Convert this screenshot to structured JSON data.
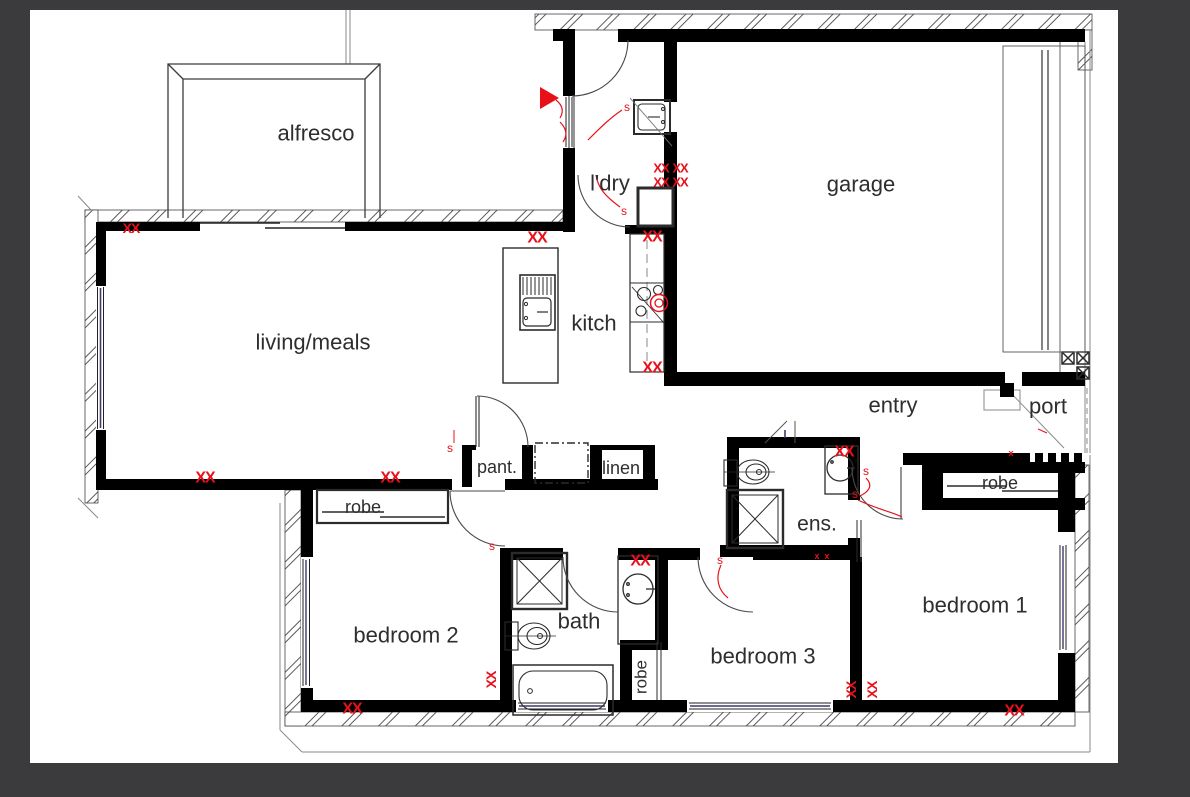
{
  "colors": {
    "background": "#3b3b3d",
    "paper": "#ffffff",
    "wall": "#000000",
    "line": "#3c3c3c",
    "faint": "#999999",
    "window_blue": "#3c3c6e",
    "marker_red": "#e8111a",
    "label": "#2e2e2e"
  },
  "rooms": [
    {
      "id": "alfresco",
      "label": "alfresco",
      "x": 316,
      "y": 133,
      "size": 22,
      "rot": 0
    },
    {
      "id": "living-meals",
      "label": "living/meals",
      "x": 313,
      "y": 342,
      "size": 22,
      "rot": 0
    },
    {
      "id": "kitchen",
      "label": "kitch",
      "x": 594,
      "y": 323,
      "size": 22,
      "rot": 0
    },
    {
      "id": "laundry",
      "label": "l'dry",
      "x": 610,
      "y": 183,
      "size": 22,
      "rot": 0
    },
    {
      "id": "garage",
      "label": "garage",
      "x": 861,
      "y": 184,
      "size": 22,
      "rot": 0
    },
    {
      "id": "entry",
      "label": "entry",
      "x": 893,
      "y": 405,
      "size": 22,
      "rot": 0
    },
    {
      "id": "port",
      "label": "port",
      "x": 1048,
      "y": 406,
      "size": 22,
      "rot": 0
    },
    {
      "id": "pantry",
      "label": "pant.",
      "x": 497,
      "y": 467,
      "size": 18,
      "rot": 0
    },
    {
      "id": "linen",
      "label": "linen",
      "x": 621,
      "y": 468,
      "size": 18,
      "rot": 0
    },
    {
      "id": "robe-bedroom2",
      "label": "robe",
      "x": 363,
      "y": 507,
      "size": 18,
      "rot": 0
    },
    {
      "id": "ensuite",
      "label": "ens.",
      "x": 817,
      "y": 524,
      "size": 21,
      "rot": 0
    },
    {
      "id": "bath",
      "label": "bath",
      "x": 579,
      "y": 621,
      "size": 22,
      "rot": 0
    },
    {
      "id": "bedroom2",
      "label": "bedroom 2",
      "x": 406,
      "y": 635,
      "size": 22,
      "rot": 0
    },
    {
      "id": "robe-bath",
      "label": "robe",
      "x": 641,
      "y": 677,
      "size": 17,
      "rot": -90
    },
    {
      "id": "bedroom3",
      "label": "bedroom 3",
      "x": 763,
      "y": 656,
      "size": 22,
      "rot": 0
    },
    {
      "id": "bedroom1",
      "label": "bedroom 1",
      "x": 975,
      "y": 605,
      "size": 22,
      "rot": 0
    },
    {
      "id": "robe-bedroom1",
      "label": "robe",
      "x": 1000,
      "y": 483,
      "size": 18,
      "rot": 0
    }
  ],
  "markers": {
    "xx_text": "XX",
    "s_text": "s",
    "small_x_text": "x",
    "xx": [
      {
        "x": 131,
        "y": 228,
        "size": 14,
        "rot": 0
      },
      {
        "x": 537,
        "y": 238,
        "size": 16,
        "rot": 0
      },
      {
        "x": 652,
        "y": 237,
        "size": 16,
        "rot": 0
      },
      {
        "x": 661,
        "y": 168,
        "size": 13,
        "rot": 0
      },
      {
        "x": 680,
        "y": 168,
        "size": 13,
        "rot": 0
      },
      {
        "x": 661,
        "y": 182,
        "size": 13,
        "rot": 0
      },
      {
        "x": 680,
        "y": 182,
        "size": 13,
        "rot": 0
      },
      {
        "x": 652,
        "y": 368,
        "size": 16,
        "rot": 0
      },
      {
        "x": 205,
        "y": 478,
        "size": 16,
        "rot": 0
      },
      {
        "x": 390,
        "y": 478,
        "size": 16,
        "rot": 0
      },
      {
        "x": 844,
        "y": 452,
        "size": 16,
        "rot": 0
      },
      {
        "x": 640,
        "y": 561,
        "size": 16,
        "rot": 0
      },
      {
        "x": 352,
        "y": 709,
        "size": 16,
        "rot": 0
      },
      {
        "x": 1014,
        "y": 711,
        "size": 16,
        "rot": 0
      },
      {
        "x": 491,
        "y": 680,
        "size": 14,
        "rot": -90
      },
      {
        "x": 851,
        "y": 690,
        "size": 14,
        "rot": -90
      },
      {
        "x": 872,
        "y": 690,
        "size": 14,
        "rot": -90
      }
    ],
    "s": [
      {
        "x": 627,
        "y": 107
      },
      {
        "x": 624,
        "y": 211
      },
      {
        "x": 450,
        "y": 448
      },
      {
        "x": 492,
        "y": 546
      },
      {
        "x": 720,
        "y": 560
      },
      {
        "x": 866,
        "y": 471
      },
      {
        "x": 855,
        "y": 494
      }
    ],
    "small_x": [
      {
        "x": 1011,
        "y": 453
      },
      {
        "x": 817,
        "y": 556
      },
      {
        "x": 827,
        "y": 556
      }
    ],
    "entry_triangle": {
      "x": 540,
      "y": 87,
      "w": 19,
      "h": 22
    }
  }
}
